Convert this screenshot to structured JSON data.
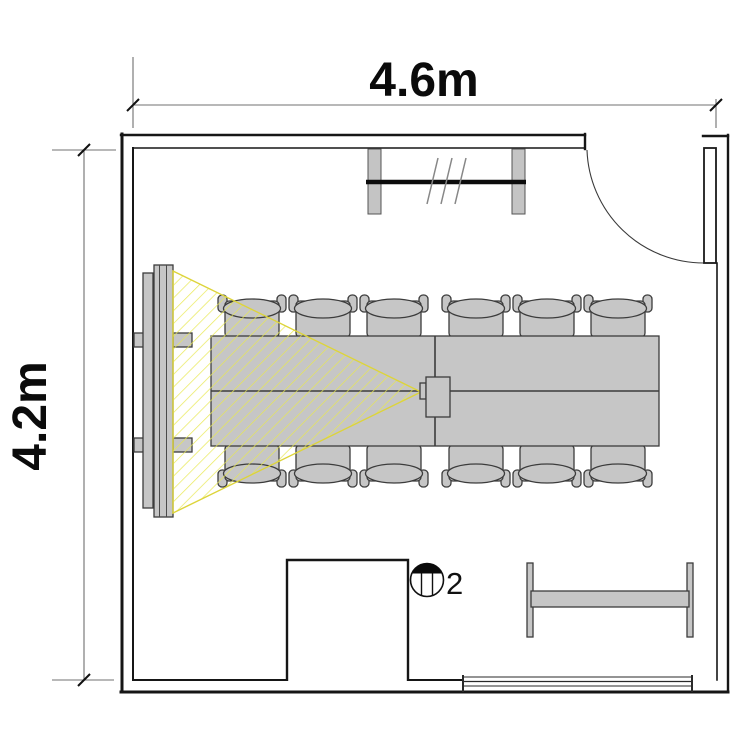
{
  "dimension_labels": {
    "width": "4.6m",
    "height": "4.2m"
  },
  "symbol_labels": {
    "device_count": "2"
  },
  "colors": {
    "cone_yellow": "#e8e84f",
    "cone_edge": "#ddd43a",
    "furniture_gray": "#c6c6c6",
    "wall_black": "#161616",
    "dim_gray": "#707070"
  }
}
